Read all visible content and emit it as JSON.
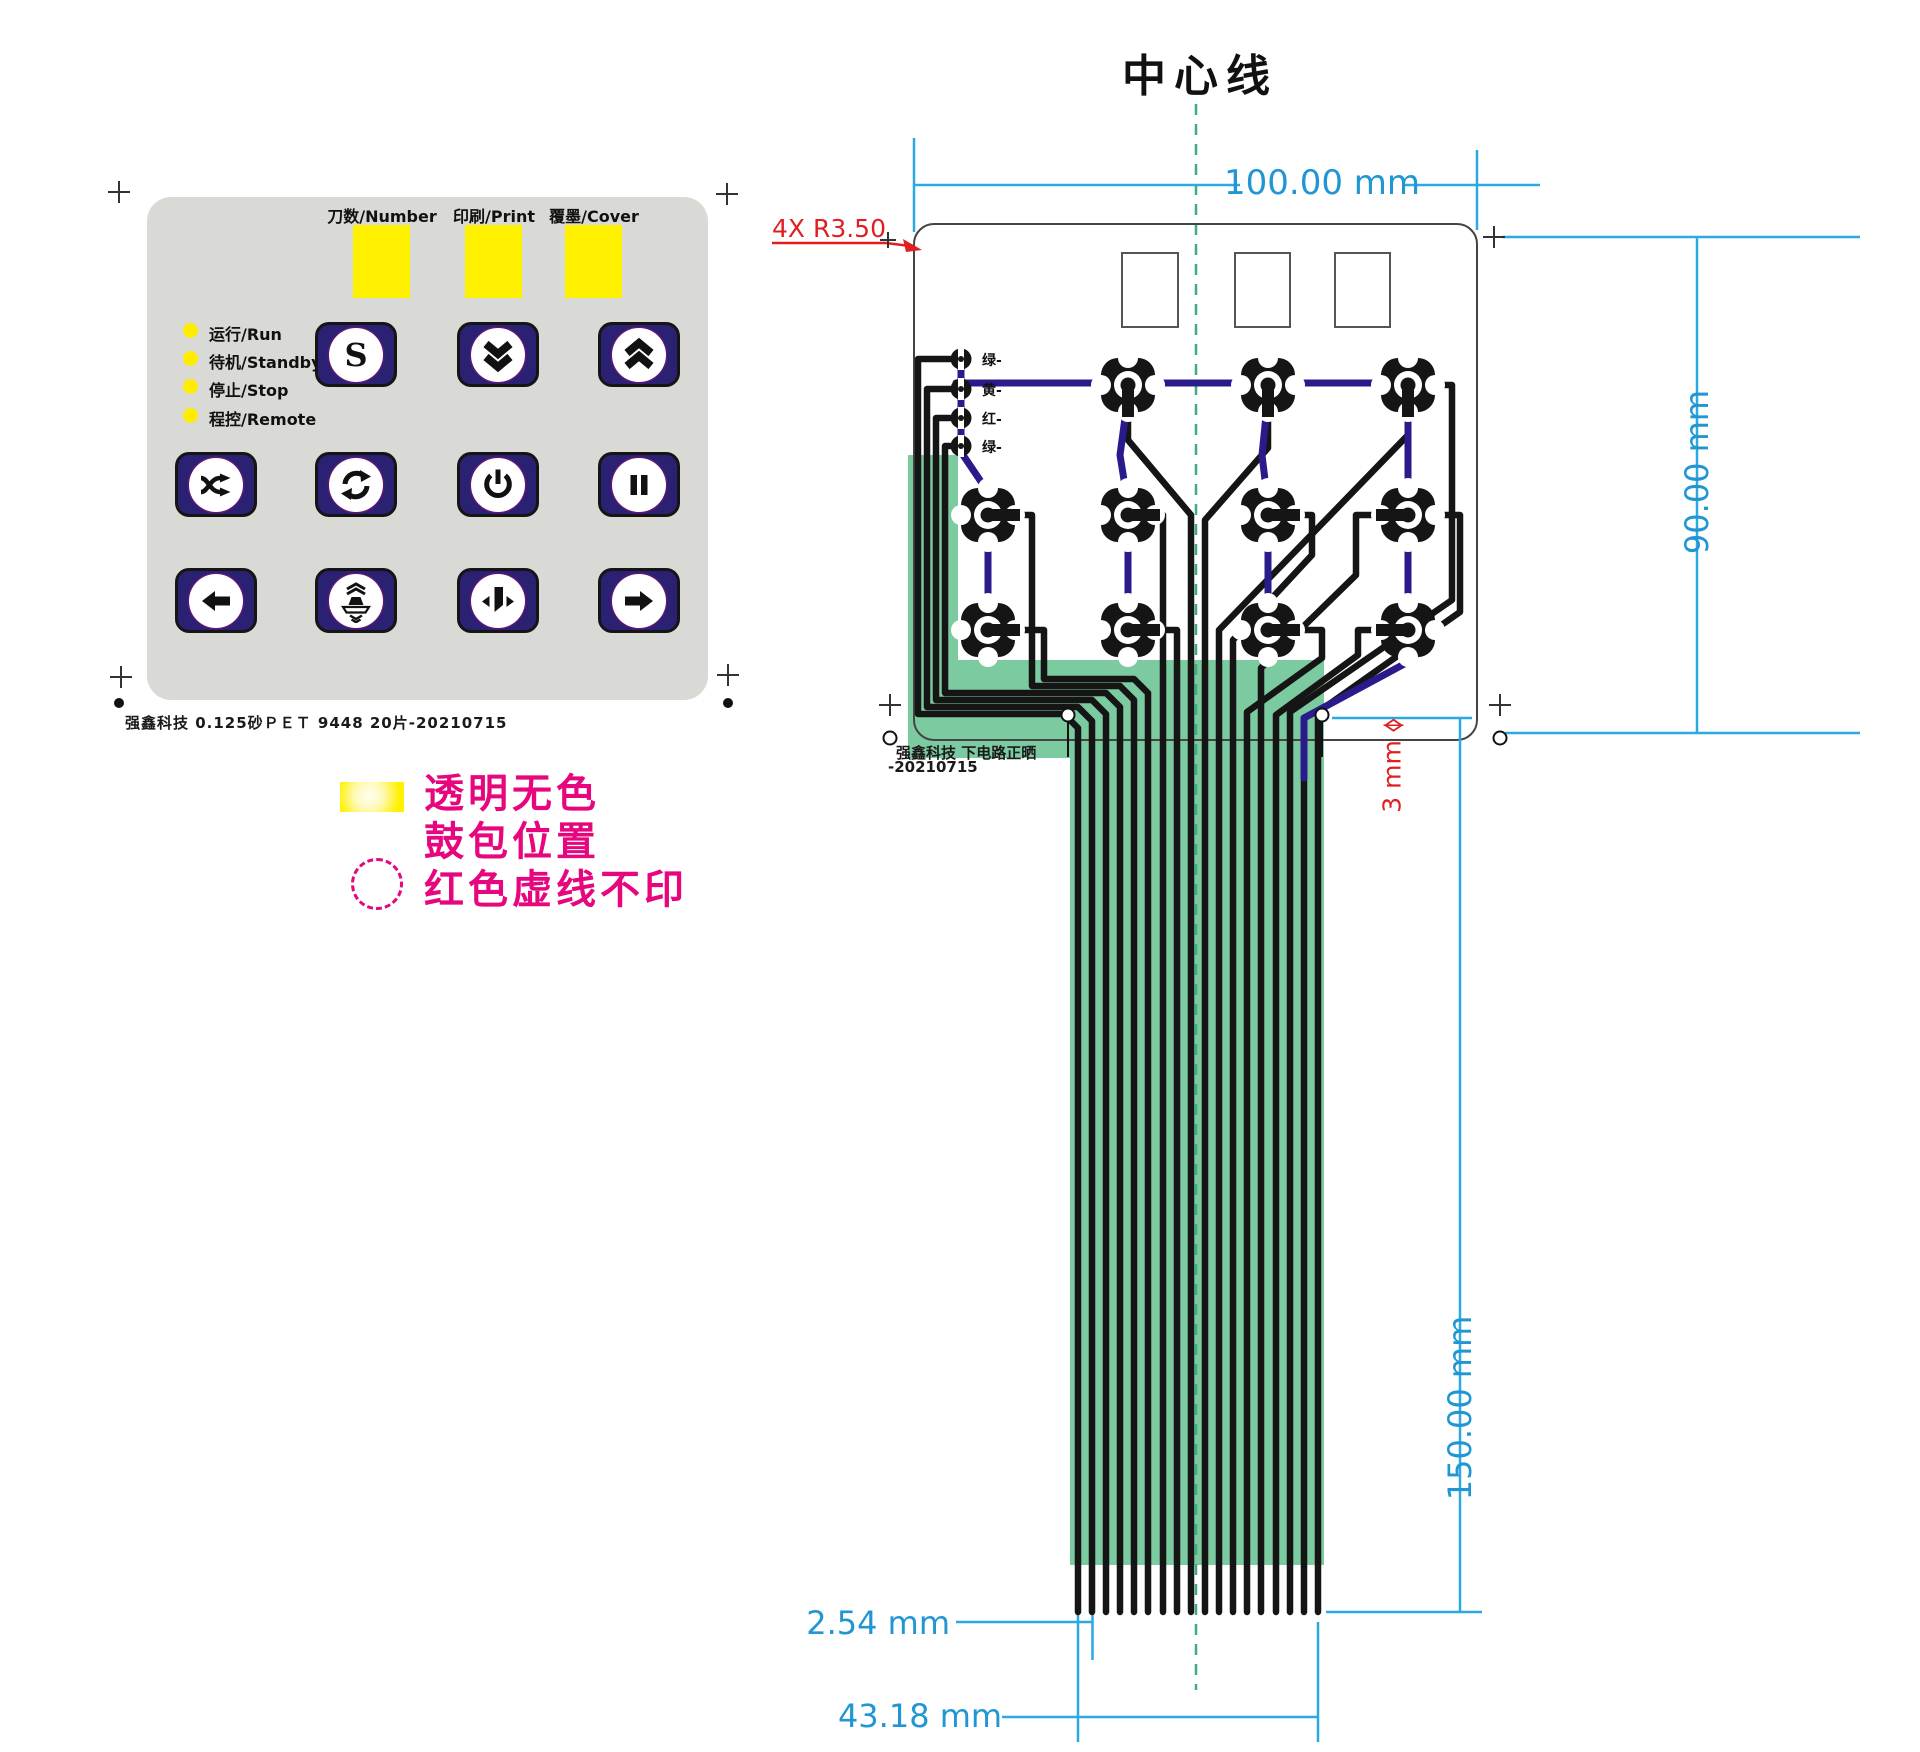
{
  "keypad": {
    "footer": "强鑫科技  0.125砂ＰＥＴ  9448  20片-20210715",
    "windows": [
      {
        "label": "刀数/Number"
      },
      {
        "label": "印刷/Print"
      },
      {
        "label": "覆墨/Cover"
      }
    ],
    "leds": [
      {
        "label": "运行/Run"
      },
      {
        "label": "待机/Standby"
      },
      {
        "label": "停止/Stop"
      },
      {
        "label": "程控/Remote"
      }
    ],
    "buttons": [
      {
        "row": 1,
        "col": 2,
        "icon": "s-icon",
        "glyph": "S",
        "name": "s-button"
      },
      {
        "row": 1,
        "col": 3,
        "icon": "chevrons-down-icon",
        "name": "double-down-button"
      },
      {
        "row": 1,
        "col": 4,
        "icon": "chevrons-up-icon",
        "name": "double-up-button"
      },
      {
        "row": 2,
        "col": 1,
        "icon": "shuffle-icon",
        "name": "shuffle-button"
      },
      {
        "row": 2,
        "col": 2,
        "icon": "cycle-icon",
        "name": "cycle-button"
      },
      {
        "row": 2,
        "col": 3,
        "icon": "power-icon",
        "name": "power-button"
      },
      {
        "row": 2,
        "col": 4,
        "icon": "pause-icon",
        "name": "pause-button"
      },
      {
        "row": 3,
        "col": 1,
        "icon": "arrow-left-icon",
        "name": "arrow-left-button"
      },
      {
        "row": 3,
        "col": 2,
        "icon": "press-icon",
        "name": "press-button"
      },
      {
        "row": 3,
        "col": 3,
        "icon": "blade-icon",
        "name": "blade-button"
      },
      {
        "row": 3,
        "col": 4,
        "icon": "arrow-right-icon",
        "name": "arrow-right-button"
      }
    ]
  },
  "legend": {
    "lines": [
      "透明无色",
      "鼓包位置",
      "红色虚线不印"
    ],
    "swatches": [
      "yellow-window-swatch",
      "red-dashed-circle"
    ]
  },
  "circuit": {
    "title": "中心线",
    "wire_labels": [
      "绿-",
      "黄-",
      "红-",
      "绿-"
    ],
    "footer_line1": "强鑫科技  下电路正晒",
    "footer_line2": "-20210715",
    "dims": {
      "width": "100.00 mm",
      "height": "90.00 mm",
      "corner_radius": "4X R3.50",
      "hole": "3 mm",
      "tail_length": "150.00 mm",
      "pitch": "2.54 mm",
      "tail_width": "43.18 mm"
    }
  },
  "colors": {
    "panel_gray": "#d9d9d5",
    "button_navy": "#2b2173",
    "window_yellow": "#fff100",
    "legend_pink": "#e6077e",
    "dim_blue": "#2196d2",
    "annot_red": "#e02020",
    "tail_green": "#7ccaa0",
    "centerline_green": "#3fae7c",
    "trace_blue": "#2a1b8c",
    "trace_black": "#151515"
  }
}
